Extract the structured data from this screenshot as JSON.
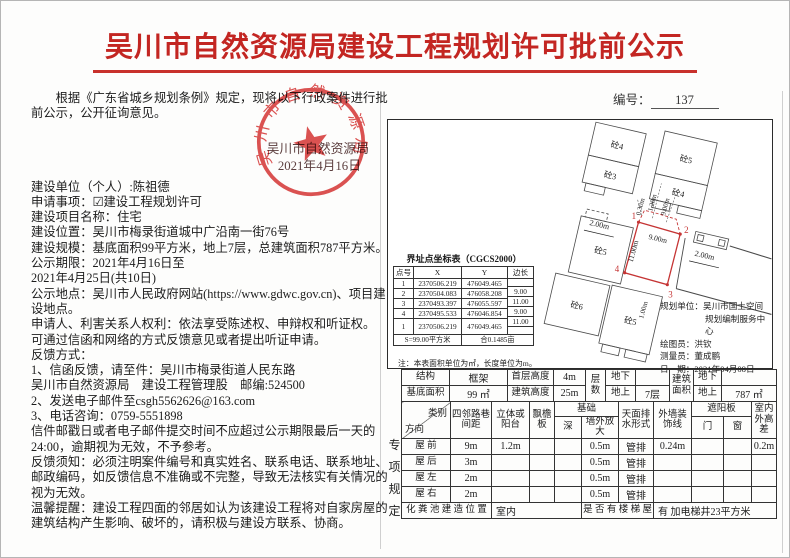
{
  "page": {
    "title": "吴川市自然资源局建设工程规划许可批前公示",
    "doc_no_label": "编号：",
    "doc_no": "137"
  },
  "notice": {
    "intro": "根据《广东省城乡规划条例》规定，现将以下行政案件进行批前公示，公开征询意见。",
    "seal": {
      "org": "吴川市自然资源局",
      "date": "2021年4月16日",
      "arc_text": "吴川市自然资源局"
    },
    "lines": [
      "建设单位（个人）:陈祖德",
      "申请事项：☑建设工程规划许可",
      "建设项目名称：住宅",
      "建设位置：吴川市梅录街道城中广沿南一街76号",
      "建设规模：基底面积99平方米，地上7层，总建筑面积787平方米。",
      "公示期限：2021年4月16日至",
      "2021年4月25日(共10日)",
      "公示地点：吴川市人民政府网站(https://www.gdwc.gov.cn)、项目建设地点。",
      "申请人、利害关系人权利：依法享受陈述权、申辩权和听证权。",
      "可通过信函和网络的方式反馈意见或者提出听证申请。",
      "反馈方式：",
      "1、信函反馈，请至件：吴川市梅录街道人民东路",
      "吴川市自然资源局　建设工程管理股　邮编:524500",
      "2、发送电子邮件至csgh5562626@163.com",
      "3、电话咨询：0759-5551898",
      "信件邮戳日或者电子邮件提交时间不应超过公示期限最后一天的24:00，逾期视为无效，不予参考。",
      "反馈须知：必须注明案件编号和真实姓名、联系电话、联系地址、邮政编码，如反馈信息不准确或不完整，导致无法核实有关情况的视为无效。",
      "温馨提醒：建设工程四面的邻居如认为该建设工程将对自家房屋的建筑结构产生影响、破坏的，请积极与建设方联系、协商。"
    ]
  },
  "map": {
    "buildings": [
      "砼4",
      "砼3",
      "砼5",
      "砼4",
      "砼5",
      "砼6",
      "砼5"
    ],
    "points": [
      "1",
      "2",
      "3",
      "4"
    ],
    "dims": {
      "top_edge": "9.00m",
      "left_edge": "11.00m",
      "gap1": "0.30m",
      "gap2": "1.20m",
      "gap3": "9.00m",
      "left": "2.00m",
      "right": "2.00m",
      "bottom": "1.00m"
    },
    "survey": {
      "unit_line1": "规划单位：吴川市国土空间",
      "unit_line2": "规划编制服务中心",
      "drafter": "绘图员：洪钦",
      "surveyor": "测量员：董成鹏",
      "date": "日　期：2021年04月08日"
    }
  },
  "coord": {
    "title": "界址点坐标表（CGCS2000）",
    "headers": [
      "点号",
      "X",
      "Y",
      "边长"
    ],
    "rows": [
      [
        "1",
        "2370506.219",
        "476049.465"
      ],
      [
        "2",
        "2370504.083",
        "476058.208"
      ],
      [
        "3",
        "2370493.397",
        "476055.597"
      ],
      [
        "4",
        "2370495.533",
        "476046.854"
      ],
      [
        "1",
        "2370506.219",
        "476049.465"
      ]
    ],
    "sides": [
      "9.00",
      "11.00",
      "9.00",
      "11.00"
    ],
    "footer_left": "S=99.00平方米",
    "footer_right": "合0.1485亩",
    "note": "注：本表面积单位为㎡，长度单位为m。"
  },
  "specs": {
    "structure_label": "结构",
    "structure": "框架",
    "first_floor_label": "首层高度",
    "first_floor": "4m",
    "floors_label": "层数",
    "below_label": "地下",
    "above_label": "地上",
    "floors_below": "",
    "floors_above": "7层",
    "gfa_label": "建筑面积",
    "gfa_below": "",
    "gfa_above": "787 ㎡",
    "base_label": "基底面积",
    "base": "99 ㎡",
    "height_label": "建筑高度",
    "height": "25m"
  },
  "matrix": {
    "vertical_label": "专项规定",
    "corner_a": "类别",
    "corner_b": "方向",
    "h_neigh": "四邻路巷间距",
    "h_balcony": "立体或阳台",
    "h_eave": "飘檐板",
    "h_found": "基础",
    "h_depth": "深",
    "h_ext": "墙外放大",
    "h_drain": "天面排水形式",
    "h_wallline": "外墙装饰线",
    "h_sunshade": "遮阳板",
    "h_door": "门",
    "h_window": "窗",
    "h_diff": "室内外高差",
    "rows": [
      {
        "label": "屋 前",
        "neigh": "9m",
        "balcony": "1.2m",
        "eave": "",
        "depth": "",
        "ext": "0.5m",
        "drain": "管排",
        "wallline": "0.24m",
        "door": "",
        "window": "",
        "diff": "0.2m"
      },
      {
        "label": "屋 后",
        "neigh": "3m",
        "balcony": "",
        "eave": "",
        "depth": "",
        "ext": "0.5m",
        "drain": "管排",
        "wallline": "",
        "door": "",
        "window": "",
        "diff": ""
      },
      {
        "label": "屋 左",
        "neigh": "2m",
        "balcony": "",
        "eave": "",
        "depth": "",
        "ext": "0.5m",
        "drain": "管排",
        "wallline": "",
        "door": "",
        "window": "",
        "diff": ""
      },
      {
        "label": "屋 右",
        "neigh": "2m",
        "balcony": "",
        "eave": "",
        "depth": "",
        "ext": "0.5m",
        "drain": "管排",
        "wallline": "",
        "door": "",
        "window": "",
        "diff": ""
      }
    ],
    "septic_label": "化 粪 池 建 造 位 置",
    "septic": "室内",
    "stair_label": "是 否 有 楼 梯 屋",
    "stair": "有  加电梯井23平方米"
  },
  "colors": {
    "title_red": "#c32622",
    "seal_red": "#d94343",
    "plot_red": "#c53434"
  }
}
